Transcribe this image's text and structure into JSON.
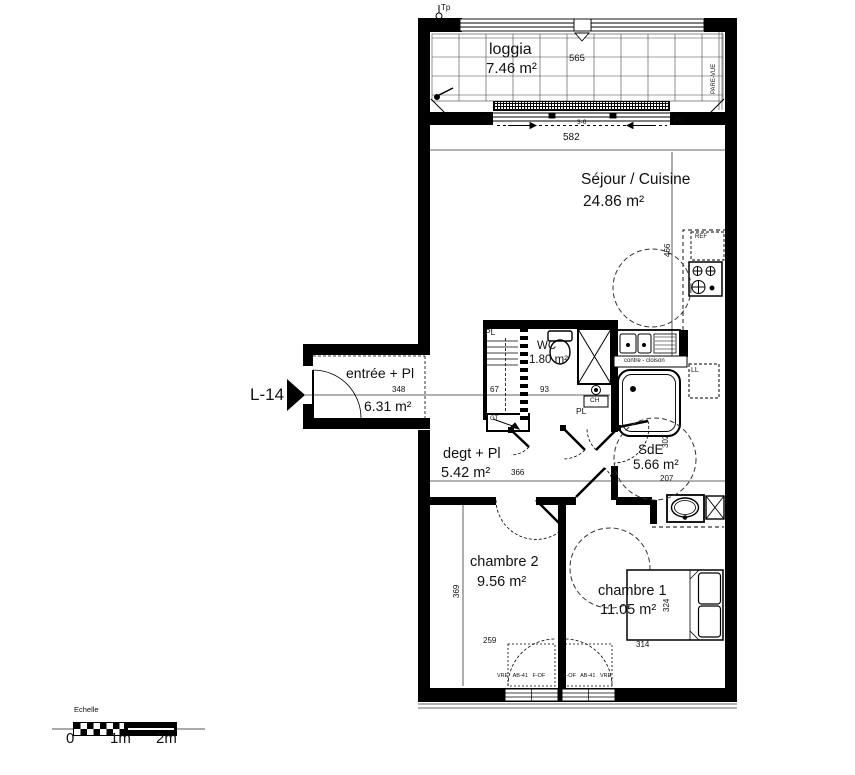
{
  "plan": {
    "unit": "L-14",
    "rooms": {
      "loggia": {
        "name": "loggia",
        "area": "7.46 m²"
      },
      "sejour": {
        "name": "Séjour / Cuisine",
        "area": "24.86 m²"
      },
      "entree": {
        "name": "entrée + Pl",
        "area": "6.31 m²"
      },
      "wc": {
        "name": "WC",
        "area": "1.80 m²"
      },
      "degagement": {
        "name": "degt + Pl",
        "area": "5.42 m²"
      },
      "sde": {
        "name": "SdE",
        "area": "5.66 m²"
      },
      "chambre2": {
        "name": "chambre 2",
        "area": "9.56 m²"
      },
      "chambre1": {
        "name": "chambre 1",
        "area": "11.05 m²"
      }
    },
    "dimensions_cm": {
      "loggia_width": "565",
      "sejour_width": "582",
      "sejour_depth": "466",
      "entree_width": "348",
      "pl_width": "67",
      "wc_width": "93",
      "degagement_width": "366",
      "sde_depth": "302",
      "sde_width": "207",
      "chambre2_depth": "369",
      "chambre2_width": "259",
      "chambre1_depth": "324",
      "chambre1_width": "314"
    },
    "annotations": {
      "tp": "Tp",
      "vre_loggia": "VRE",
      "bay_code": "3-6",
      "pc": "PC",
      "pare_vue": "PARE-VUE",
      "ref": "REF",
      "contre_cloison": "contre - cloison",
      "lave_linge": "LL",
      "placard_closet": "PL",
      "chauffe_eau": "CH",
      "placard_hall": "PL",
      "gaine_technique": "GT",
      "window_left": "VRE   AB-41   F-OF",
      "window_right": "F-OF   AB-41   VRE"
    },
    "scale_bar": {
      "title": "Echelle",
      "tick_0": "0",
      "tick_1": "1m",
      "tick_2": "2m"
    }
  }
}
